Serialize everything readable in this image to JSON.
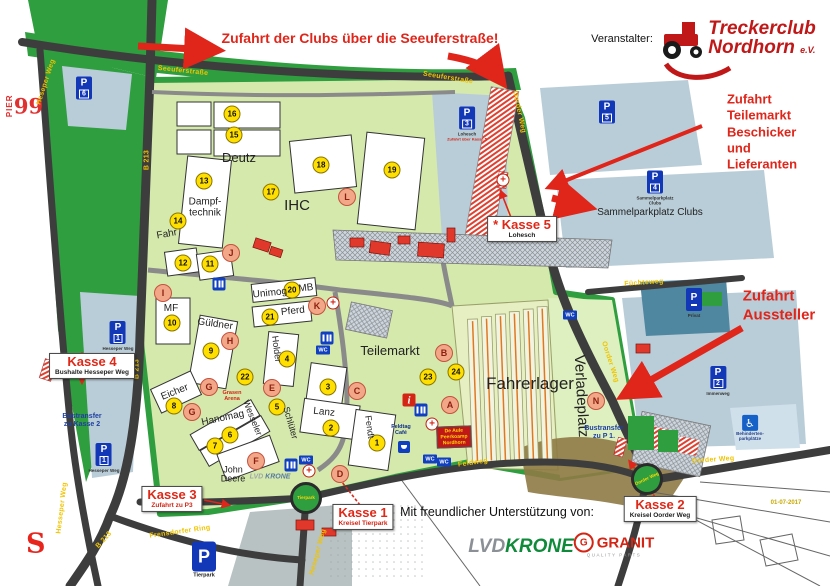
{
  "meta": {
    "pier_top": "PIER",
    "pier_num": "99",
    "date_note": "01-07-2017"
  },
  "organizer": {
    "label": "Veranstalter:",
    "line1": "Treckerclub",
    "line2": "Nordhorn",
    "suffix": "e.V."
  },
  "notices": {
    "clubs": "Zufahrt der Clubs über die Seeuferstraße!",
    "teilemarkt": "Zufahrt\nTeilemarkt\nBeschicker und\nLieferanten",
    "aussteller": "Zufahrt\nAussteller"
  },
  "kassen": [
    {
      "name": "Kasse 1",
      "sub": "Kreisel Tierpark",
      "x": 363,
      "y": 517,
      "cls": "red"
    },
    {
      "name": "Kasse 2",
      "sub": "Kreisel Oorder Weg",
      "x": 660,
      "y": 509
    },
    {
      "name": "Kasse 3",
      "sub": "Zufahrt zu P3",
      "x": 172,
      "y": 499,
      "cls": "red"
    },
    {
      "name": "Kasse 4",
      "sub": "Bushalte Hesseper Weg",
      "x": 92,
      "y": 366
    },
    {
      "name": "* Kasse 5",
      "sub": "Lohesch",
      "x": 522,
      "y": 229
    }
  ],
  "parking_signs": [
    {
      "p": "P",
      "n": "6",
      "x": 84,
      "y": 88
    },
    {
      "p": "P",
      "n": "1",
      "x": 118,
      "y": 336,
      "label": "Hesseper Weg"
    },
    {
      "p": "P",
      "n": "1",
      "x": 104,
      "y": 458,
      "label": "Hesseper Weg"
    },
    {
      "p": "P",
      "n": "3",
      "x": 467,
      "y": 124,
      "label": "Lohesch",
      "note": "Zufahrt über Kasse 5"
    },
    {
      "p": "P",
      "n": "5",
      "x": 607,
      "y": 112
    },
    {
      "p": "P",
      "n": "4",
      "x": 655,
      "y": 188,
      "label": "Sammelparkplatz Clubs"
    },
    {
      "p": "P",
      "n": "2",
      "x": 718,
      "y": 381,
      "label": "Immenweg"
    },
    {
      "p": "P",
      "n": "",
      "x": 694,
      "y": 303,
      "label": "Privat"
    }
  ],
  "tierpark_p": {
    "p": "P",
    "label": "Tierpark",
    "x": 204,
    "y": 560
  },
  "handicap": {
    "symbol": "♿",
    "label": "Behinderten-\nparkplätze",
    "x": 750,
    "y": 428
  },
  "markers": {
    "numbers": [
      {
        "n": "1",
        "x": 377,
        "y": 443
      },
      {
        "n": "2",
        "x": 331,
        "y": 428
      },
      {
        "n": "3",
        "x": 328,
        "y": 387
      },
      {
        "n": "4",
        "x": 287,
        "y": 359
      },
      {
        "n": "5",
        "x": 277,
        "y": 407
      },
      {
        "n": "6",
        "x": 230,
        "y": 435
      },
      {
        "n": "7",
        "x": 215,
        "y": 446
      },
      {
        "n": "8",
        "x": 174,
        "y": 406
      },
      {
        "n": "9",
        "x": 211,
        "y": 351
      },
      {
        "n": "10",
        "x": 172,
        "y": 323
      },
      {
        "n": "11",
        "x": 210,
        "y": 264
      },
      {
        "n": "12",
        "x": 183,
        "y": 263
      },
      {
        "n": "13",
        "x": 204,
        "y": 181
      },
      {
        "n": "14",
        "x": 178,
        "y": 221
      },
      {
        "n": "15",
        "x": 234,
        "y": 135
      },
      {
        "n": "16",
        "x": 232,
        "y": 114
      },
      {
        "n": "17",
        "x": 271,
        "y": 192
      },
      {
        "n": "18",
        "x": 321,
        "y": 165
      },
      {
        "n": "19",
        "x": 392,
        "y": 170
      },
      {
        "n": "20",
        "x": 292,
        "y": 290
      },
      {
        "n": "21",
        "x": 270,
        "y": 317
      },
      {
        "n": "22",
        "x": 245,
        "y": 377
      },
      {
        "n": "23",
        "x": 428,
        "y": 377
      },
      {
        "n": "24",
        "x": 456,
        "y": 372
      }
    ],
    "letters": [
      {
        "ch": "A",
        "x": 450,
        "y": 405
      },
      {
        "ch": "B",
        "x": 444,
        "y": 353
      },
      {
        "ch": "C",
        "x": 357,
        "y": 391
      },
      {
        "ch": "D",
        "x": 340,
        "y": 474
      },
      {
        "ch": "E",
        "x": 272,
        "y": 388
      },
      {
        "ch": "F",
        "x": 256,
        "y": 461
      },
      {
        "ch": "G",
        "x": 209,
        "y": 387
      },
      {
        "ch": "G",
        "x": 192,
        "y": 412
      },
      {
        "ch": "H",
        "x": 230,
        "y": 341
      },
      {
        "ch": "I",
        "x": 163,
        "y": 293
      },
      {
        "ch": "J",
        "x": 231,
        "y": 253
      },
      {
        "ch": "K",
        "x": 317,
        "y": 306
      },
      {
        "ch": "L",
        "x": 347,
        "y": 197
      },
      {
        "ch": "N",
        "x": 596,
        "y": 401
      }
    ]
  },
  "streets": [
    {
      "text": "Seeuferstraße",
      "x": 183,
      "y": 71,
      "rotate": 6
    },
    {
      "text": "Seeuferstraße",
      "x": 448,
      "y": 78,
      "rotate": 9
    },
    {
      "text": "Heseper Weg",
      "x": 46,
      "y": 82,
      "rotate": -72
    },
    {
      "text": "B 213",
      "x": 147,
      "y": 160,
      "rotate": -90
    },
    {
      "text": "B 213",
      "x": 137,
      "y": 369,
      "rotate": -90
    },
    {
      "text": "B 213",
      "x": 104,
      "y": 540,
      "rotate": -48
    },
    {
      "text": "Hesseper Weg",
      "x": 62,
      "y": 508,
      "rotate": -83
    },
    {
      "text": "Frensdorfer Ring",
      "x": 180,
      "y": 532,
      "rotate": -8
    },
    {
      "text": "Heseper Weg",
      "x": 318,
      "y": 552,
      "rotate": -75
    },
    {
      "text": "Oorder Weg",
      "x": 519,
      "y": 112,
      "rotate": 78
    },
    {
      "text": "Oorder Weg",
      "x": 610,
      "y": 362,
      "rotate": 72
    },
    {
      "text": "Oorder Weg",
      "x": 713,
      "y": 460,
      "rotate": -4
    },
    {
      "text": "Füchteweg",
      "x": 644,
      "y": 283,
      "rotate": -4
    },
    {
      "text": "Feldweg",
      "x": 473,
      "y": 463,
      "rotate": -8
    }
  ],
  "areas": [
    {
      "text": "Deutz",
      "x": 239,
      "y": 158,
      "size": 13
    },
    {
      "text": "IHC",
      "x": 297,
      "y": 206,
      "size": 15
    },
    {
      "text": "Dampf-\ntechnik",
      "x": 205,
      "y": 208
    },
    {
      "text": "Fahr",
      "x": 167,
      "y": 235,
      "rotate": -10
    },
    {
      "text": "MF",
      "x": 171,
      "y": 309
    },
    {
      "text": "Güldner",
      "x": 215,
      "y": 325,
      "rotate": 8
    },
    {
      "text": "Unimog",
      "x": 270,
      "y": 294,
      "rotate": -6
    },
    {
      "text": "MB",
      "x": 306,
      "y": 289,
      "rotate": -6
    },
    {
      "text": "Pferd",
      "x": 293,
      "y": 312,
      "rotate": -6
    },
    {
      "text": "Holder",
      "x": 276,
      "y": 349,
      "size": 9,
      "rotate": 83
    },
    {
      "text": "Eicher",
      "x": 175,
      "y": 393,
      "rotate": -22
    },
    {
      "text": "Hanomag",
      "x": 223,
      "y": 419,
      "rotate": -12
    },
    {
      "text": "Lanz",
      "x": 324,
      "y": 413,
      "rotate": 6
    },
    {
      "text": "Fendt",
      "x": 369,
      "y": 427,
      "size": 9,
      "rotate": 82
    },
    {
      "text": "Wesseler",
      "x": 252,
      "y": 418,
      "size": 9,
      "rotate": 68
    },
    {
      "text": "Schlüter",
      "x": 290,
      "y": 423,
      "size": 9,
      "rotate": 74
    },
    {
      "text": "John\nDeere",
      "x": 233,
      "y": 475,
      "size": 9
    },
    {
      "text": "Teilemarkt",
      "x": 390,
      "y": 351,
      "size": 13
    },
    {
      "text": "Fahrerlager",
      "x": 530,
      "y": 384,
      "size": 17
    },
    {
      "text": "Verladeplatz",
      "x": 581,
      "y": 396,
      "size": 15,
      "rotate": 87
    },
    {
      "text": "Sammelparkplatz Clubs",
      "x": 650,
      "y": 213,
      "size": 10
    }
  ],
  "transfers": [
    {
      "text": "Bustransfer\nzu Kasse 2",
      "x": 82,
      "y": 421
    },
    {
      "text": "Bustransfer\nzu P 1.",
      "x": 604,
      "y": 433
    }
  ],
  "roundabouts": [
    {
      "label": "Tierpark",
      "x": 306,
      "y": 498
    },
    {
      "label": "Oorder Weg",
      "x": 647,
      "y": 479,
      "rotate": -25
    }
  ],
  "toilets": [
    {
      "x": 219,
      "y": 284
    },
    {
      "x": 327,
      "y": 338
    },
    {
      "x": 291,
      "y": 465
    },
    {
      "x": 421,
      "y": 410
    }
  ],
  "wc_signs": [
    {
      "t": "WC",
      "x": 323,
      "y": 350
    },
    {
      "t": "WC",
      "x": 570,
      "y": 315
    },
    {
      "t": "WC",
      "x": 306,
      "y": 460
    },
    {
      "t": "WC",
      "x": 430,
      "y": 459
    },
    {
      "t": "WC",
      "x": 444,
      "y": 462
    }
  ],
  "first_aid": [
    {
      "t": "+",
      "x": 333,
      "y": 303
    },
    {
      "t": "+",
      "x": 432,
      "y": 424
    },
    {
      "t": "+",
      "x": 309,
      "y": 471
    },
    {
      "t": "+",
      "x": 503,
      "y": 180
    }
  ],
  "poi": {
    "info": "i",
    "red_sign": "De Aule\nPeerkoamp\nNordhorn",
    "cafe_label": "Feldtag\nCafé",
    "arena": "Grasen\nArena",
    "small_lvd_1": "LVD ",
    "small_lvd_2": "KRONE"
  },
  "sponsors": {
    "heading": "Mit freundlicher Unterstützung von:",
    "sparkasse": "S",
    "lvd": "LVD",
    "krone": "KRONE",
    "granit_g": "G",
    "granit": "GRANIT",
    "granit_sub": "QUALITY PARTS"
  }
}
